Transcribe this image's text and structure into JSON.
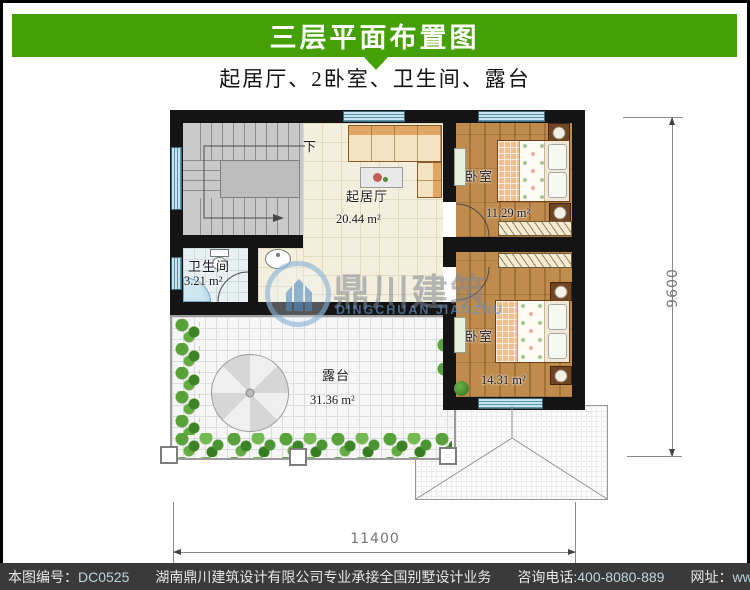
{
  "header": {
    "title": "三层平面布置图",
    "subtitle": "起居厅、2卧室、卫生间、露台"
  },
  "plan": {
    "rooms": [
      {
        "name": "living-room",
        "label": "起居厅",
        "area": "20.44 m²"
      },
      {
        "name": "bedroom-top",
        "label": "卧室",
        "area": "11.29 m²"
      },
      {
        "name": "bedroom-bottom",
        "label": "卧室",
        "area": "14.31 m²"
      },
      {
        "name": "bathroom",
        "label": "卫生间",
        "area": "3.21 m²"
      },
      {
        "name": "terrace",
        "label": "露台",
        "area": "31.36 m²"
      }
    ],
    "stairs_down_label": "下",
    "dimensions": {
      "width": "11400",
      "height": "9600"
    }
  },
  "watermark": {
    "cn": "鼎川建筑",
    "en": "DINGCHUAN JIANZHU"
  },
  "footer": {
    "id_label": "本图编号：",
    "id_value": "DC0525",
    "company": "湖南鼎川建筑设计有限公司专业承接全国别墅设计业务",
    "phone_label": "咨询电话:",
    "phone_value": "400-8080-889",
    "web_label": "网址：",
    "web_value": "www.bstzcs.com"
  },
  "colors": {
    "header_green": "#45a006",
    "footer_bg": "#3a3a3a",
    "footer_highlight": "#b9d6dd",
    "wall": "#141414"
  }
}
